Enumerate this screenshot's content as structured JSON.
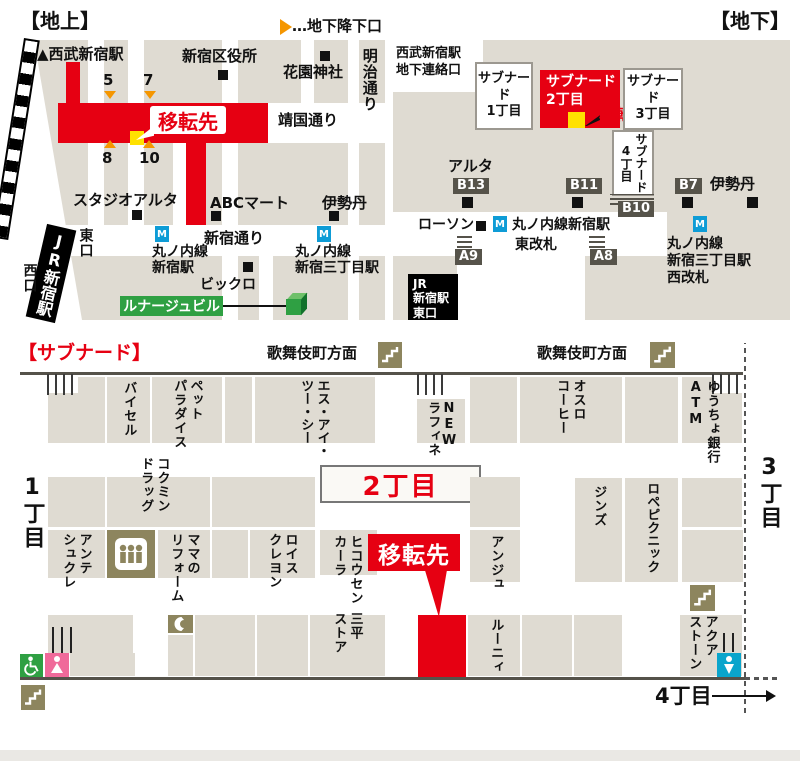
{
  "titles": {
    "ground": "【地上】",
    "underground": "【地下】",
    "subnade": "【サブナード】"
  },
  "legend": {
    "note": "…地下降下口"
  },
  "ground": {
    "seibu_marker": "▲",
    "seibu": "西武新宿駅",
    "ward_office": "新宿区役所",
    "hanazono": "花園神社",
    "meiji_dori": "明治通り",
    "yasukuni_dori": "靖国通り",
    "relocation": "移転先",
    "n5": "5",
    "n7": "7",
    "n8": "8",
    "n10": "10",
    "studio_alta": "スタジオアルタ",
    "abc_mart": "ABCマート",
    "isetan": "伊勢丹",
    "jr_shinjuku": "JR新宿駅",
    "east_exit": "東口",
    "west_exit": "西口",
    "shinjuku_dori": "新宿通り",
    "marunouchi_shinjuku": "丸ノ内線\n新宿駅",
    "marunouchi_sanchome": "丸ノ内線\n新宿三丁目駅",
    "bicqlo": "ビックロ",
    "lunage": "ルナージュビル"
  },
  "underground": {
    "seibu_link": "西武新宿駅\n地下連絡口",
    "subnade1": "サブナード\n1丁目",
    "subnade2": "サブナード\n2丁目",
    "subnade3": "サブナード\n3丁目",
    "subnade4": "サブナード\n4丁目",
    "relocation": "移転先",
    "alta": "アルタ",
    "b13": "B13",
    "b11": "B11",
    "b7": "B7",
    "b10": "B10",
    "a9": "A9",
    "a8": "A8",
    "isetan": "伊勢丹",
    "lawson": "ローソン",
    "marunouchi_east": "丸ノ内線新宿駅",
    "east_gate": "東改札",
    "marunouchi_west": "丸ノ内線\n新宿三丁目駅\n西改札",
    "jr_east": "JR\n新宿駅\n東口"
  },
  "subnade": {
    "kabukicho1": "歌舞伎町方面",
    "kabukicho2": "歌舞伎町方面",
    "district1": "1丁目",
    "district2": "2丁目",
    "district3": "3丁目",
    "district4": "4丁目",
    "relocation": "移転先",
    "shops": {
      "buysell": "バイセル",
      "pet_paradise": "ペット\nパラダイス",
      "sic": "エス・アイ・\nツー・シー",
      "new_raffine": "NEW\nラフィネ",
      "oslo_coffee": "オスロ\nコーヒー",
      "yucho": "ゆうちょ銀行\nATM",
      "kokumin": "コクミン\nドラッグ",
      "ante_sucre": "アンテ\nシュクレ",
      "mama_reform": "ママの\nリフォーム",
      "lois_crayon": "ロイス\nクレヨン",
      "hikousen": "ヒコウセン\nカーラ",
      "sanpei": "三平\nストア",
      "ange": "アンジュ",
      "jins": "ジンズ",
      "rope_picnic": "ロペピクニック",
      "rooney": "ルーニィ",
      "aqua_stone": "アクア\nストーン"
    }
  },
  "icons": {
    "metro_letter": "M"
  },
  "colors": {
    "accent_red": "#e60012",
    "block_beige": "#dfdbd2",
    "tan_icon": "#8d855e",
    "metro_blue": "#0e9cd6",
    "green": "#2fa043",
    "pink": "#f06a9a",
    "cyan": "#0aa5cc",
    "orange": "#f59600",
    "dark_label": "#56534a"
  }
}
